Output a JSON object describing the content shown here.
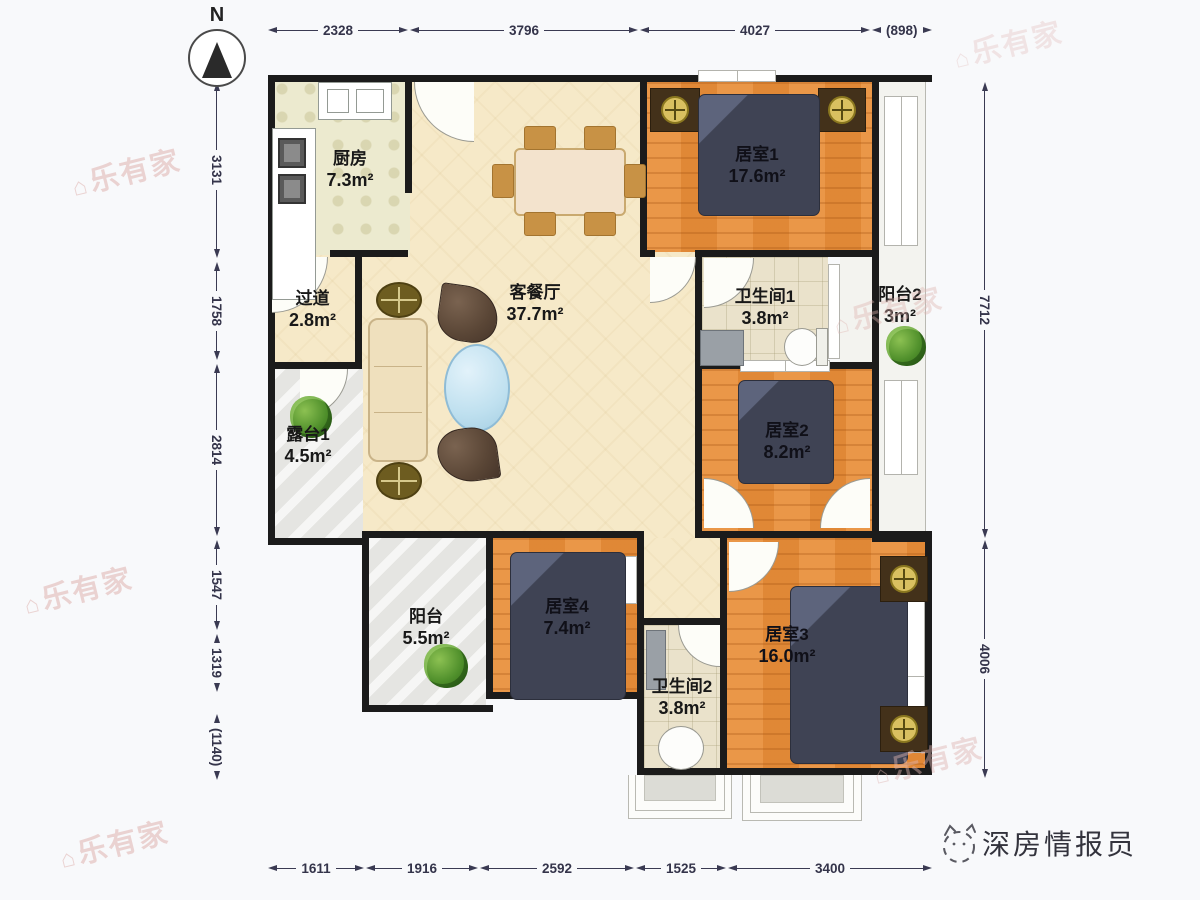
{
  "north_label": "N",
  "dimensions": {
    "top": [
      "2328",
      "3796",
      "4027",
      "(898)"
    ],
    "left": [
      "3131",
      "1758",
      "2814",
      "1547",
      "1319",
      "(1140)"
    ],
    "right": [
      "7712",
      "4006"
    ],
    "bottom": [
      "1611",
      "1916",
      "2592",
      "1525",
      "3400"
    ]
  },
  "rooms": {
    "kitchen": {
      "label": "厨房",
      "area": "7.3m²"
    },
    "hallway": {
      "label": "过道",
      "area": "2.8m²"
    },
    "living": {
      "label": "客餐厅",
      "area": "37.7m²"
    },
    "bedroom1": {
      "label": "居室1",
      "area": "17.6m²"
    },
    "bath1": {
      "label": "卫生间1",
      "area": "3.8m²"
    },
    "balcony2": {
      "label": "阳台2",
      "area": "3m²"
    },
    "terrace1": {
      "label": "露台1",
      "area": "4.5m²"
    },
    "bedroom2": {
      "label": "居室2",
      "area": "8.2m²"
    },
    "balcony": {
      "label": "阳台",
      "area": "5.5m²"
    },
    "bedroom4": {
      "label": "居室4",
      "area": "7.4m²"
    },
    "bath2": {
      "label": "卫生间2",
      "area": "3.8m²"
    },
    "bedroom3": {
      "label": "居室3",
      "area": "16.0m²"
    }
  },
  "watermark": {
    "text": "乐有家",
    "icon": "⌂"
  },
  "brand": {
    "name": "深房情报员"
  },
  "colors": {
    "wall": "#1b1b1b",
    "wood_floor": "#e48c3a",
    "living_floor": "#f6e9c8",
    "bed": "#3f4354",
    "dimension": "#3a3a52",
    "watermark": "#dfb4b0"
  }
}
